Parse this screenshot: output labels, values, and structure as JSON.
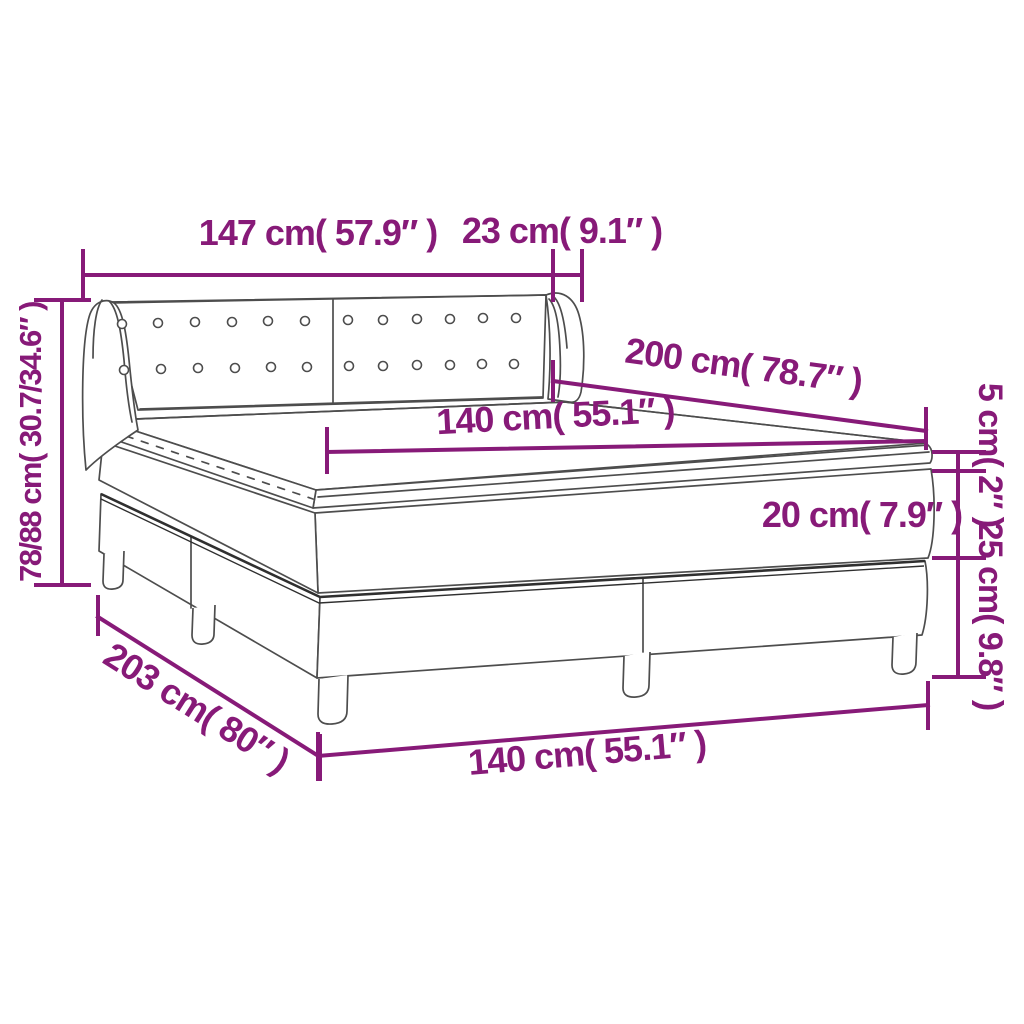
{
  "title": "Box spring bed with mattress — dimension diagram",
  "colors": {
    "dimension_accent": "#871a78",
    "line_art": "#4d4d4d",
    "line_art_dark": "#2f2f2f",
    "background": "#ffffff"
  },
  "labels": {
    "headboard_width": "147 cm( 57.9″ )",
    "wing_width": "23 cm( 9.1″ )",
    "headboard_height": "78/88 cm( 30.7/34.6″ )",
    "mattress_length": "200 cm( 78.7″ )",
    "mattress_width": "140 cm( 55.1″ )",
    "topper_thickness": "5 cm( 2″ )",
    "mattress_thickness": "20 cm( 7.9″ )",
    "base_height": "25 cm( 9.8″ )",
    "base_length": "203 cm( 80″ )",
    "base_width": "140 cm( 55.1″ )"
  }
}
